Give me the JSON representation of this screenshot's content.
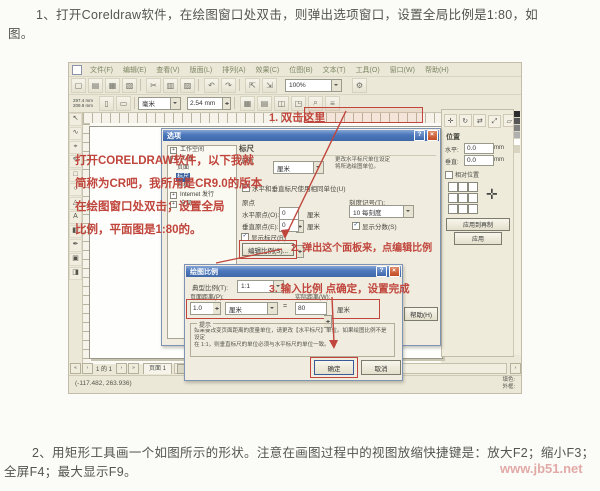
{
  "colors": {
    "annotation_red": "#c0453c",
    "titlebar_blue": "#4a77bb",
    "app_bg": "#ebe8d7"
  },
  "page": {
    "para1_line1": "1、打开Coreldraw软件，在绘图窗口处双击，则弹出选项窗口，设置全局比例是1:80，如",
    "para1_line2": "图。",
    "para2_line1": "2、用矩形工具画一个如图所示的形状。注意在画图过程中的视图放缩快捷键是：放大F2；缩小F3；",
    "para2_line2": "全屏F4；最大显示F9。",
    "watermark": "www.jb51.net"
  },
  "app": {
    "menus": [
      "文件(F)",
      "编辑(E)",
      "查看(V)",
      "版面(L)",
      "排列(A)",
      "效果(C)",
      "位图(B)",
      "文本(T)",
      "工具(O)",
      "窗口(W)",
      "帮助(H)"
    ],
    "toolbar": {
      "zoom_value": "100%"
    },
    "propbar": {
      "width": "297.4 mm",
      "height": "209.9 mm",
      "units": "毫米",
      "nudge": "2.54 mm"
    },
    "annotations": {
      "ruler_note": "1. 双击这里",
      "canvas_note_l1": "打开CORELDRAW软件，以下我就",
      "canvas_note_l2": "简称为CR吧，我所用是CR9.0的版本",
      "canvas_note_l3": "在绘图窗口处双击；设置全局",
      "canvas_note_l4": "比例，平面图是1:80的。"
    },
    "pagebar": {
      "page_info": "1 的 1",
      "tab": "页面 1"
    },
    "statusbar": {
      "coords": "(-117.482, 263.936)",
      "fill_label": "填色:",
      "outline_label": "外框:"
    }
  },
  "options_dialog": {
    "title": "选项",
    "tree": [
      "工作空间",
      "文档",
      "页面",
      "标尺",
      "网格",
      "Internet 发行",
      "全局"
    ],
    "panel_title": "标尺",
    "unit_label": "单位",
    "unit_value": "厘米",
    "unit_hint1": "更改水平标尺单位设定",
    "unit_hint2": "将所选绘图单位。",
    "same_units": "水平和垂直标尺使用相同单位(U)",
    "origin_label": "原点",
    "h_origin_label": "水平原点(O):",
    "v_origin_label": "垂直原点(E):",
    "origin_value": "0",
    "cm": "厘米",
    "tick_label": "刻度记号(T):",
    "tick_value": "10 每刻度",
    "show_fractions": "显示分数(S)",
    "show_rulers": "显示标尺(R)",
    "edit_scale_btn": "编辑比例(S)...",
    "help_btn": "帮助(H)",
    "note": "2. 弹出这个面板来，点编辑比例"
  },
  "scale_dialog": {
    "title": "绘图比例",
    "typical_label": "典型比例(T):",
    "typical_value": "1:1",
    "note": "3. 输入比例 点确定，设置完成",
    "page_dist_label": "页面距离(P):",
    "page_dist_value": "1.0",
    "real_dist_label": "实际距离(W):",
    "real_dist_value": "80",
    "equals": "=",
    "cm": "厘米",
    "hint_title": "提示",
    "hint_l1": "如果要改变页面距离的度量单位，请更改【水平标尺】单位。如果绘图比例不是设定",
    "hint_l2": "在 1:1，则垂直标尺的单位必须与水平标尺的单位一致。",
    "ok": "确定",
    "cancel": "取消"
  },
  "docker": {
    "pos_label": "位置",
    "h_label": "水平:",
    "v_label": "垂直:",
    "h_value": "0.0",
    "v_value": "0.0",
    "unit": "mm",
    "relative": "相对位置",
    "apply_dup": "应用到再制",
    "apply": "应用"
  }
}
